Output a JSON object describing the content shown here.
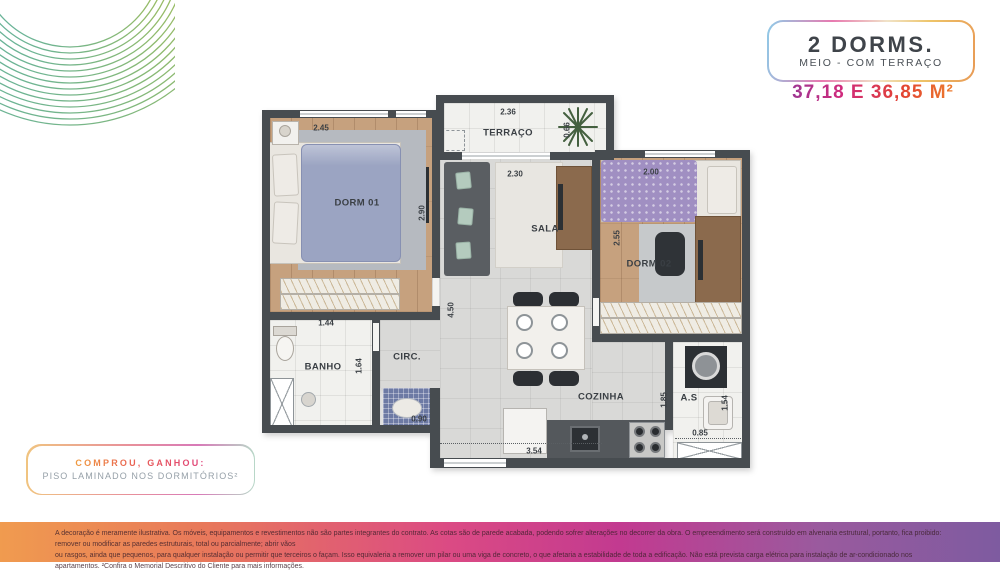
{
  "header": {
    "badge_title": "2 DORMS.",
    "badge_subtitle": "MEIO - COM TERRAÇO",
    "area": "37,18 E 36,85 M²"
  },
  "promo": {
    "line1": "COMPROU, GANHOU:",
    "line2": "PISO LAMINADO NOS DORMITÓRIOS²"
  },
  "plan": {
    "rooms": {
      "dorm01": {
        "label": "DORM 01",
        "cota_w": "2.45",
        "cota_h": "2.90"
      },
      "terraco": {
        "label": "TERRAÇO",
        "cota_w": "2.36",
        "cota_h": "0.66"
      },
      "sala": {
        "label": "SALA",
        "cota_w": "2.30",
        "cota_h": "4.50"
      },
      "dorm02": {
        "label": "DORM 02",
        "cota_w": "2.00",
        "cota_h": "2.55"
      },
      "banho": {
        "label": "BANHO",
        "cota_w": "1.44",
        "cota_h": "1.64"
      },
      "circ": {
        "label": "CIRC.",
        "cota_w": "0.90"
      },
      "cozinha": {
        "label": "COZINHA",
        "cota_w": "3.54"
      },
      "as": {
        "label": "A.S",
        "cota_h_left": "1.85",
        "cota_h_right": "1.54",
        "cota_w": "0.85"
      }
    }
  },
  "footer": {
    "line1": "A decoração é meramente ilustrativa. Os móveis, equipamentos e revestimentos não são partes integrantes do contrato. As cotas são de parede acabada, podendo sofrer alterações no decorrer da obra. O empreendimento será construído em alvenaria estrutural, portanto, fica proibido: remover ou modificar as paredes estruturais, total ou parcialmente; abrir vãos",
    "line2": "ou rasgos, ainda que pequenos, para qualquer instalação ou permitir que terceiros o façam. Isso equivaleria a remover um pilar ou uma viga de concreto, o que afetaria a estabilidade de toda a edificação. Não está prevista carga elétrica para instalação de ar-condicionado nos apartamentos. ²Confira o Memorial Descritivo do Cliente para mais informações."
  },
  "colors": {
    "wall": "#474c50",
    "accent_gradient": [
      "#8a3c9c",
      "#d02a7c",
      "#e34430",
      "#f0932c"
    ],
    "footer_gradient": [
      "#f09b4f",
      "#db4a84",
      "#7e5ba0"
    ]
  }
}
